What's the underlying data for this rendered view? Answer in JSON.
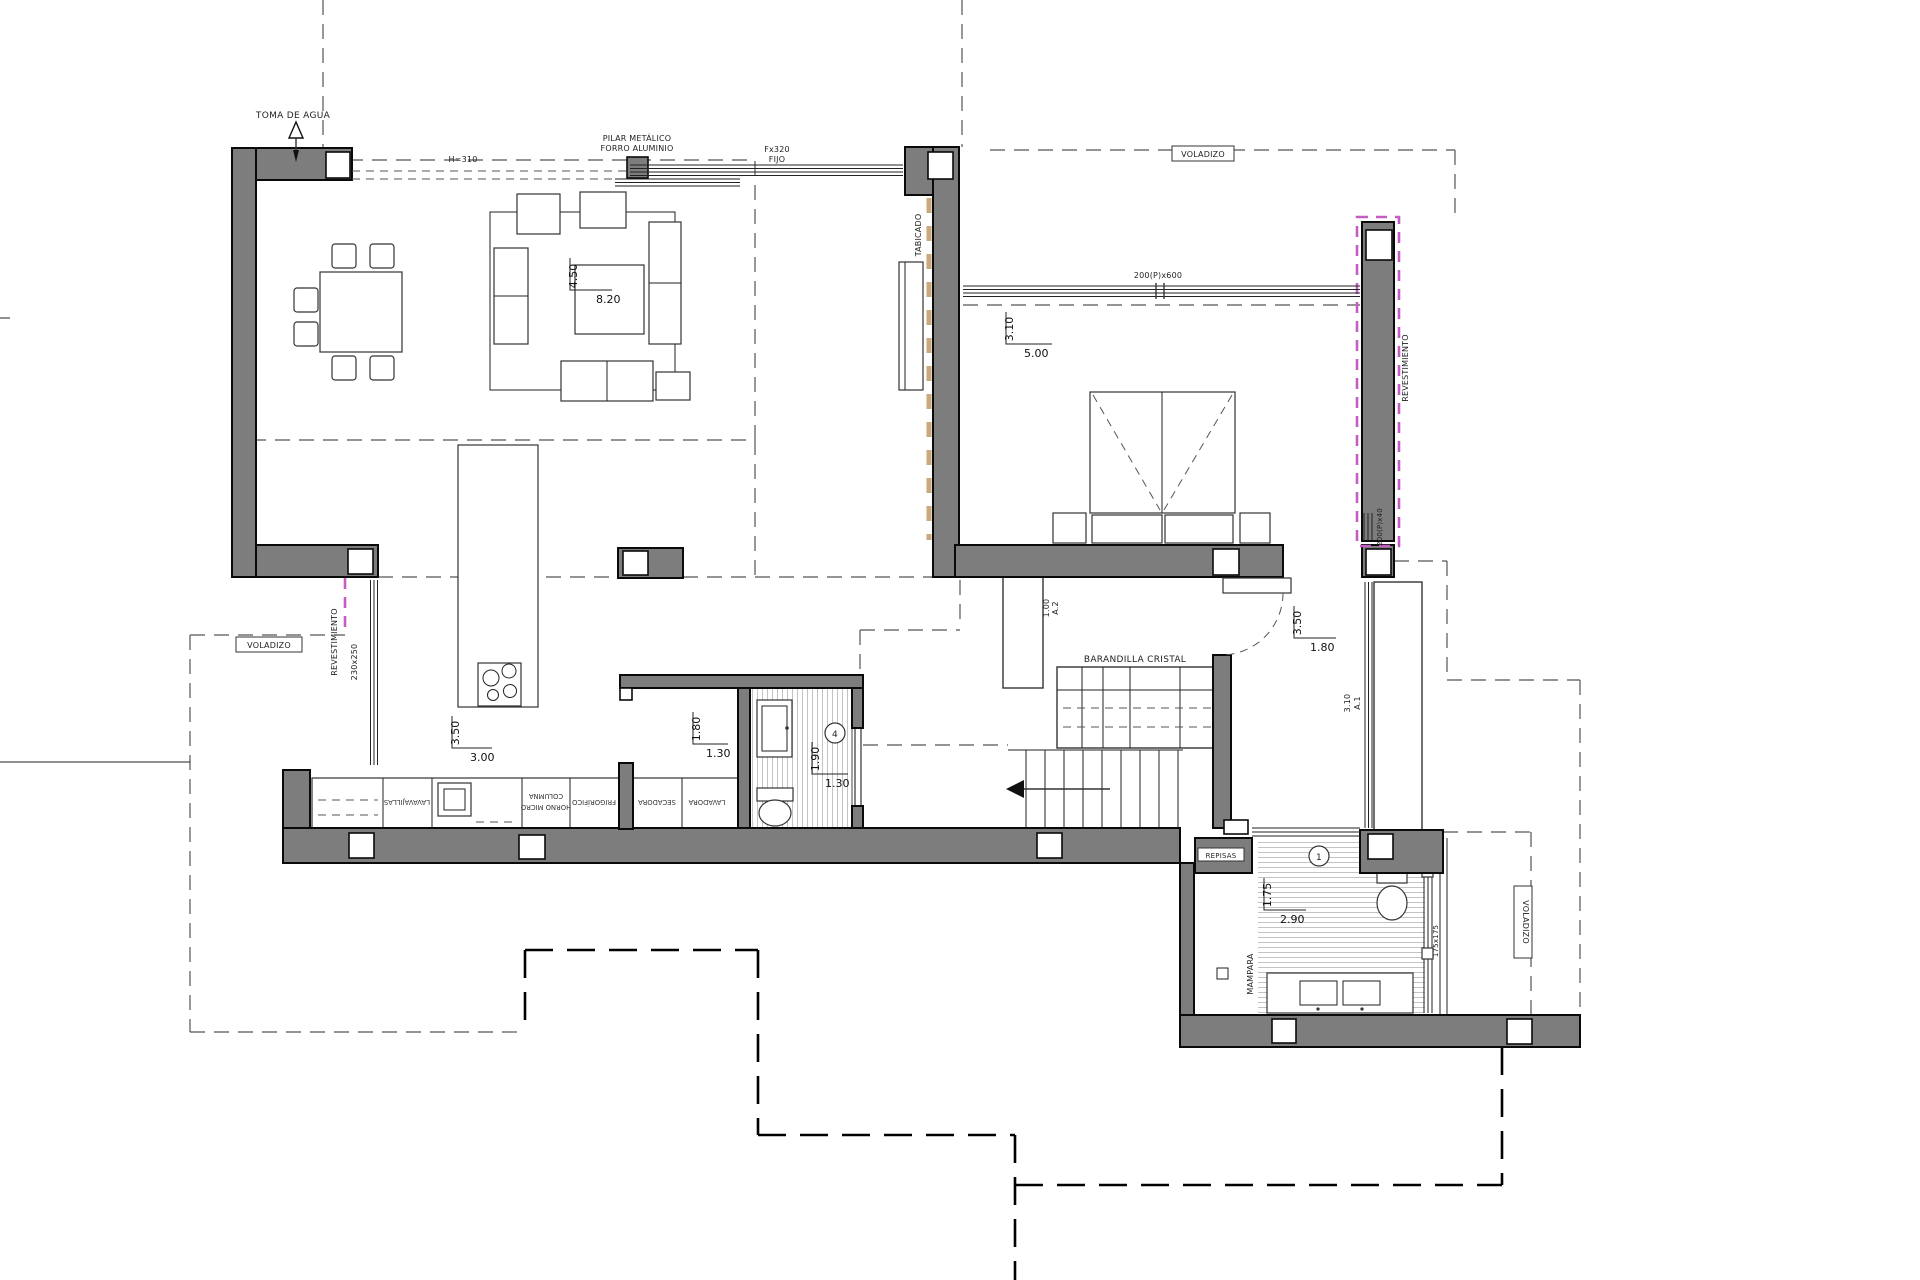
{
  "drawing": {
    "annotations": {
      "toma_de_agua": "TOMA DE AGUA",
      "pilar_metalico_1": "PILAR METÁLICO",
      "pilar_metalico_2": "FORRO ALUMINIO",
      "beam_height": "H=310",
      "window_fixed_1": "Fx320",
      "window_fixed_2": "FIJO",
      "voladizo_top": "VOLADIZO",
      "voladizo_left": "VOLADIZO",
      "voladizo_right": "VOLADIZO",
      "tabicado": "TABICADO",
      "bedroom_window": "200(P)x600",
      "small_window": "200(P)x40",
      "revestimiento_right": "REVESTIMIENTO",
      "revestimiento_left": "REVESTIMIENTO",
      "revestimiento_left_size": "230x250",
      "barandilla_cristal": "BARANDILLA CRISTAL",
      "repisas": "REPISAS",
      "mampara": "MAMPARA",
      "mampara_size": "175x175",
      "wardrobe_a1": "A.1",
      "wardrobe_a1_size": "3.10",
      "wardrobe_a2": "A.2",
      "wardrobe_a2_size": "1.00",
      "room_number_1": "1",
      "room_number_4": "4"
    },
    "dimensions": {
      "living": {
        "a": "4.50",
        "b": "8.20"
      },
      "kitchen": {
        "a": "3.50",
        "b": "3.00"
      },
      "laundry": {
        "a": "1.80",
        "b": "1.30"
      },
      "bath_small": {
        "a": "1.90",
        "b": "1.30"
      },
      "bedroom": {
        "a": "3.10",
        "b": "5.00"
      },
      "hall": {
        "a": "3.50",
        "b": "1.80"
      },
      "bath_main": {
        "a": "1.75",
        "b": "2.90"
      }
    },
    "appliances": {
      "dishwasher": "LAVAVAJILLAS",
      "column_1": "COLUMNA",
      "column_2": "HORNO MICRO",
      "fridge": "FRIGORÍFICO",
      "dryer": "SECADORA",
      "washer": "LAVADORA"
    },
    "colors": {
      "wall": "#7d7d7d",
      "cladding_dash": "#c45ec4",
      "partition_dash": "#c9a87d"
    }
  }
}
